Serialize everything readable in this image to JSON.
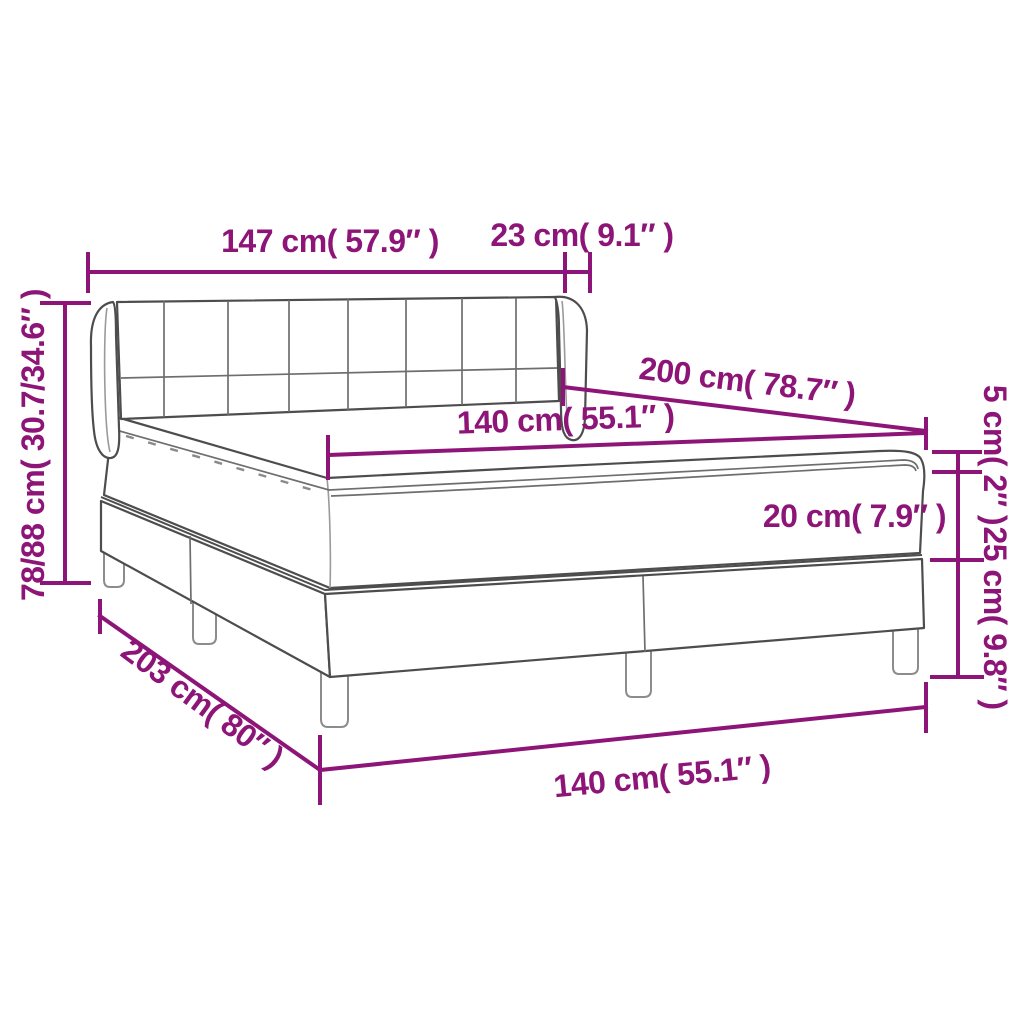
{
  "diagram": {
    "subject": "box spring bed with headboard, mattress topper and split base",
    "colors": {
      "accent": "#8E1578",
      "line": "#4d4d4d",
      "background": "#ffffff"
    },
    "labels": {
      "headboard_width": "147 cm( 57.9″ )",
      "headboard_side_depth": "23 cm( 9.1″ )",
      "overall_height": "78/88 cm( 30.7/34.6″ )",
      "bed_length": "200 cm( 78.7″ )",
      "mattress_width": "140 cm( 55.1″ )",
      "topper_thickness": "5 cm( 2″ )",
      "mattress_thickness": "20 cm( 7.9″ )",
      "base_height": "25 cm( 9.8″ )",
      "frame_length": "203 cm( 80″ )",
      "base_width": "140 cm( 55.1″ )"
    }
  }
}
